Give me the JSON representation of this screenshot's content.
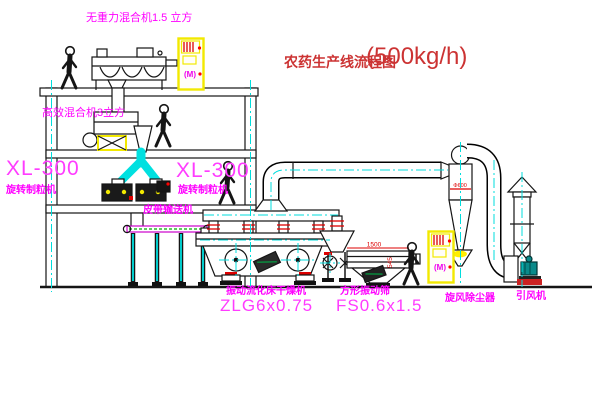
{
  "title": {
    "name": "农药生产线流程图",
    "capacity": "(500kg/h)"
  },
  "equipment": {
    "gravity_mixer": {
      "label": "无重力混合机1.5 立方"
    },
    "high_eff_mixer": {
      "label": "高效混合机3立方"
    },
    "granulator_left": {
      "model": "XL-300",
      "name": "旋转制粒机"
    },
    "granulator_right": {
      "model": "XL-300",
      "name": "旋转制粒机"
    },
    "belt_conveyor": {
      "label": "皮带输送机"
    },
    "fluid_bed_dryer": {
      "name": "振动流化床干燥机",
      "model": "ZLG6x0.75"
    },
    "vibrating_screen": {
      "name": "方形振动筛",
      "model": "FS0.6x1.5"
    },
    "cyclone": {
      "label": "旋风除尘器"
    },
    "draft_fan": {
      "label": "引风机"
    }
  },
  "dimensions": {
    "screen_length": "1500",
    "screen_height": "545",
    "cyclone_note": "Φ600"
  },
  "control_cabinet": {
    "panel_label": "(M)"
  },
  "colors": {
    "label_magenta": "#ff00ff",
    "title_red": "#cc3333",
    "centerline_cyan": "#00dddd",
    "cabinet_yellow": "#f2e900",
    "flange_red": "#dd0000",
    "belt_magenta": "#cc00cc"
  }
}
